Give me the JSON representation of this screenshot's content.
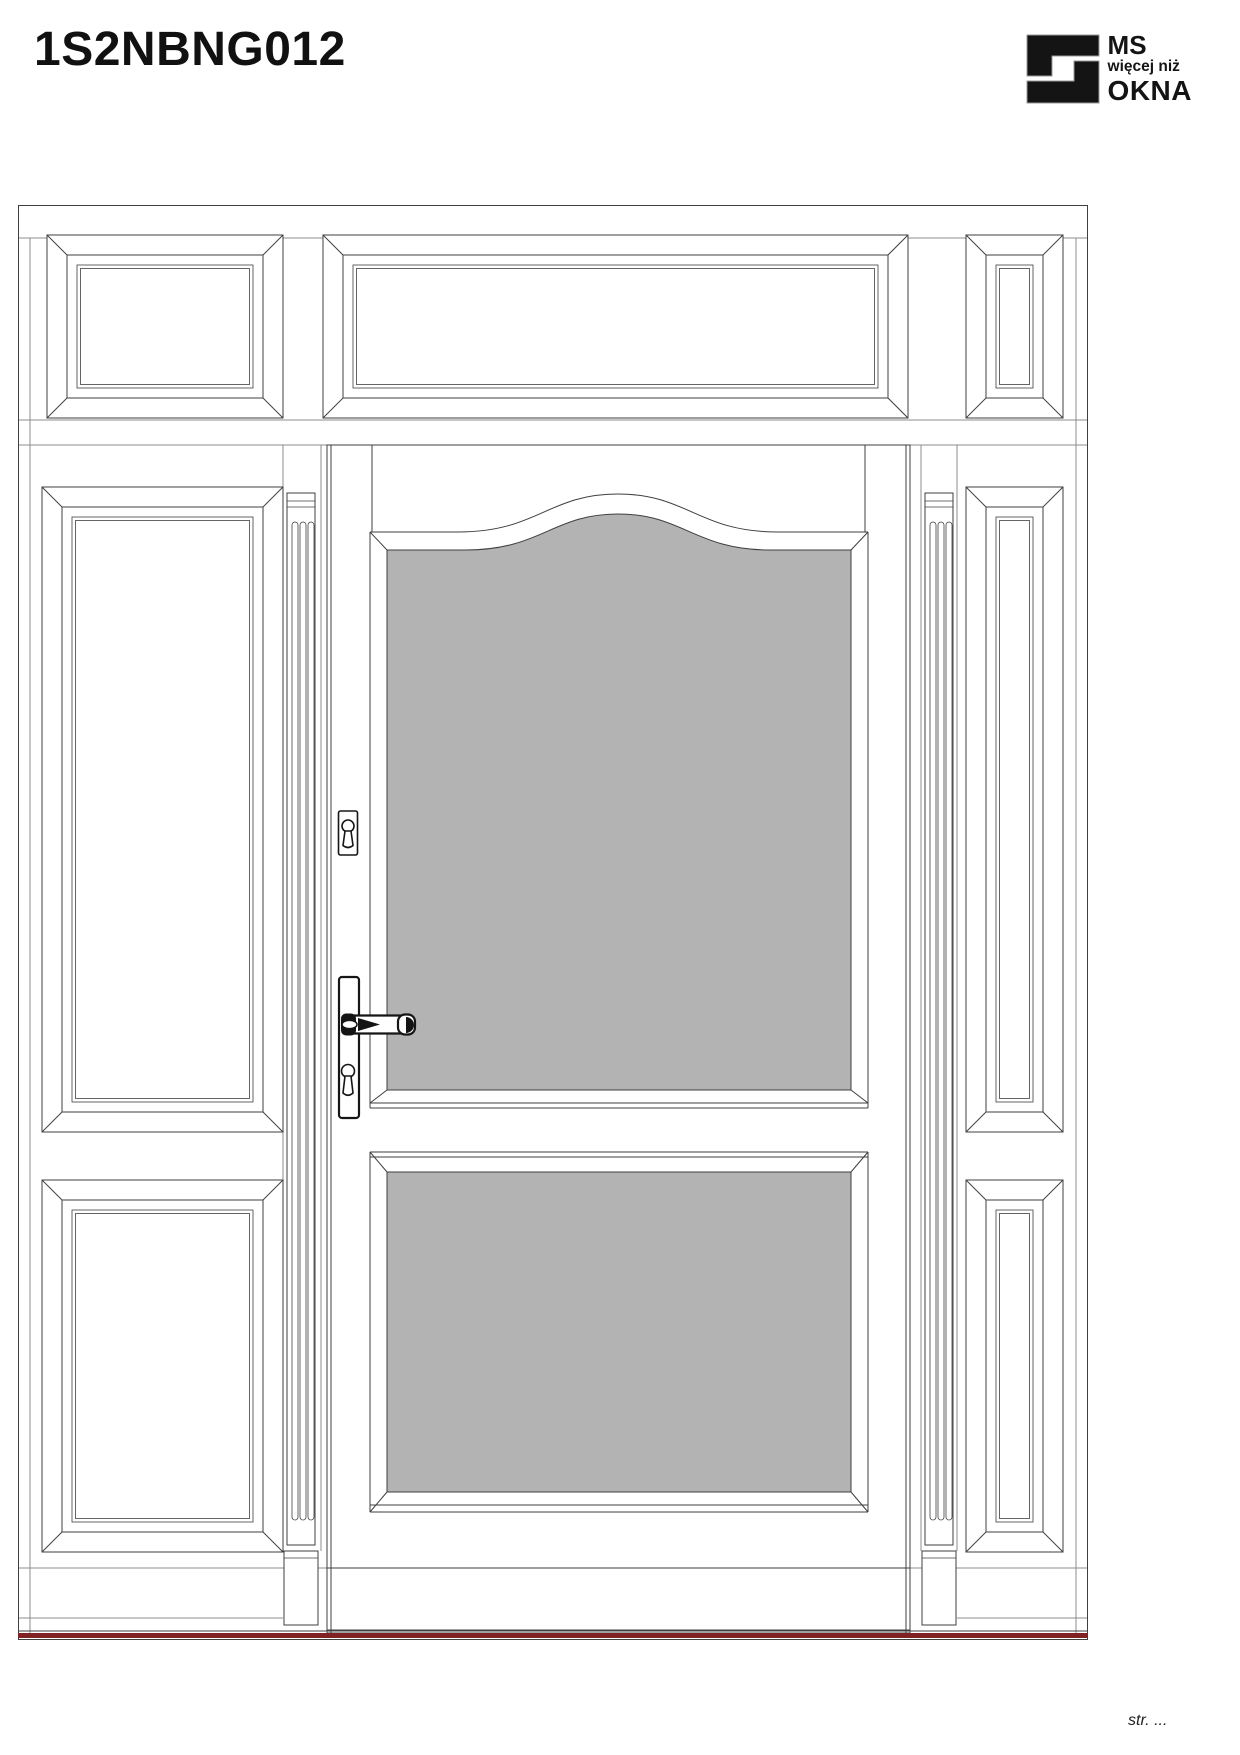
{
  "header": {
    "title": "1S2NBNG012",
    "logo": {
      "line1": "MS",
      "line2": "więcej niż",
      "line3": "OKNA"
    }
  },
  "footer": {
    "page_ref": "str. ..."
  },
  "colors": {
    "ink": "#141414",
    "line": "#3f3f3f",
    "soft": "#8c8c8c",
    "glass": "#b3b3b3",
    "threshold": "#7e2222",
    "paper": "#ffffff"
  }
}
